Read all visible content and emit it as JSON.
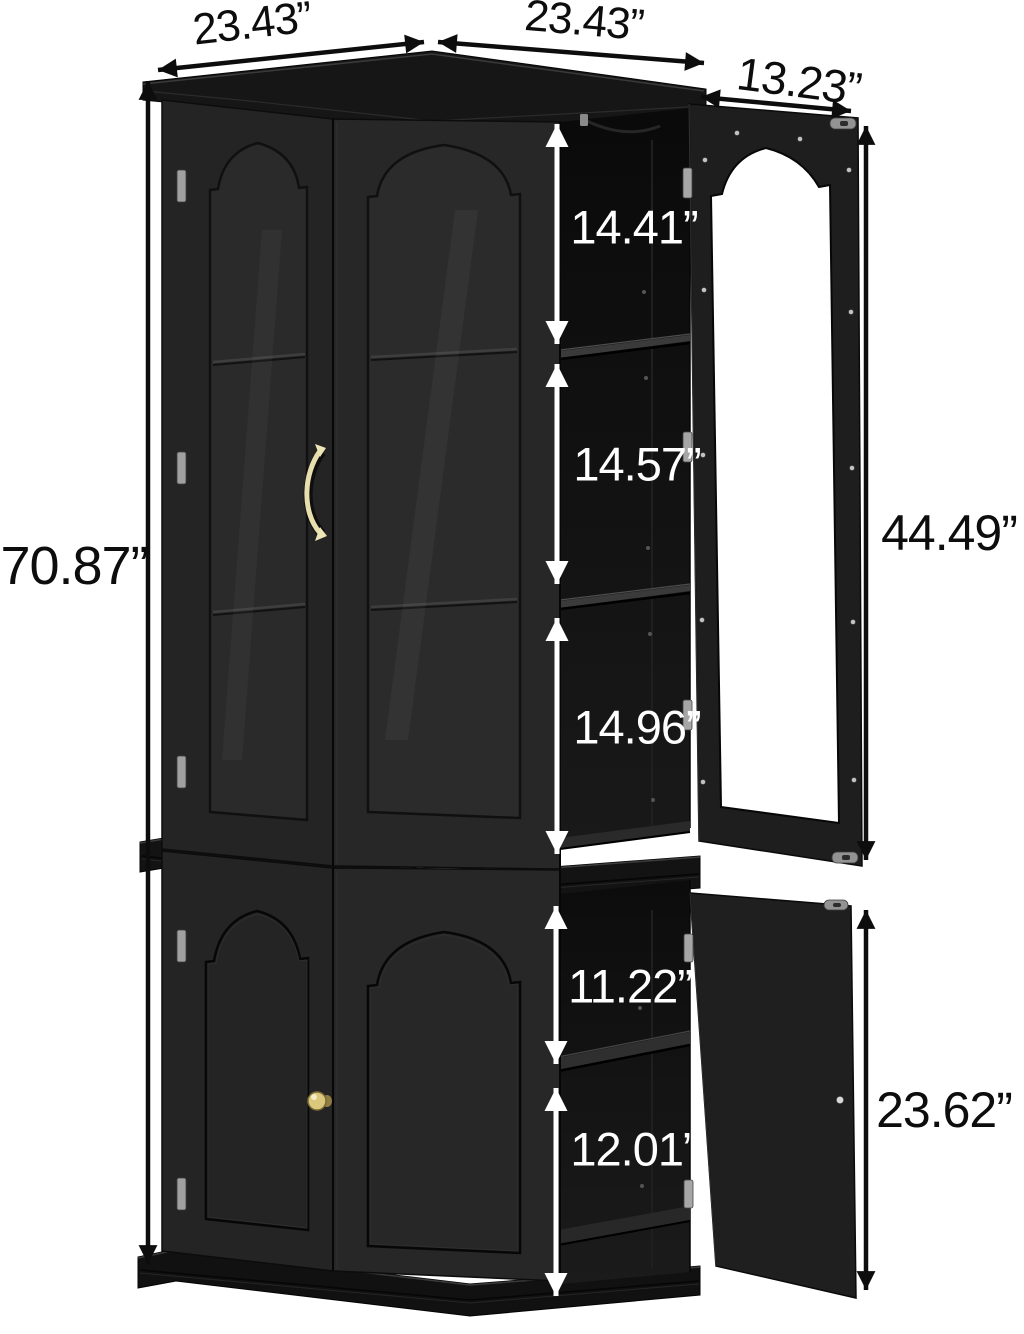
{
  "figure": {
    "type": "product dimension diagram",
    "subject": "Two-tier black corner display cabinet with arched glass doors; upper glass door and lower panel door shown open on the right",
    "background": "#ffffff"
  },
  "dimensions": {
    "top_left_width": "23.43”",
    "top_right_width": "23.43”",
    "open_door_width": "13.23”",
    "total_height": "70.87”",
    "upper_section_1_height": "14.41”",
    "upper_section_2_height": "14.57”",
    "upper_section_3_height": "14.96”",
    "upper_door_height": "44.49”",
    "lower_section_1_height": "11.22”",
    "lower_section_2_height": "12.01”",
    "lower_door_height": "23.62”"
  },
  "colors": {
    "cabinet_body": "#242424",
    "cabinet_dark_trim": "#131313",
    "annotation_dark": "#0d0d0d",
    "annotation_light": "#ffffff",
    "handle_gold": "#e8dfae",
    "knob_gold": "#dcc87c",
    "open_door_glass": "#ffffff"
  }
}
